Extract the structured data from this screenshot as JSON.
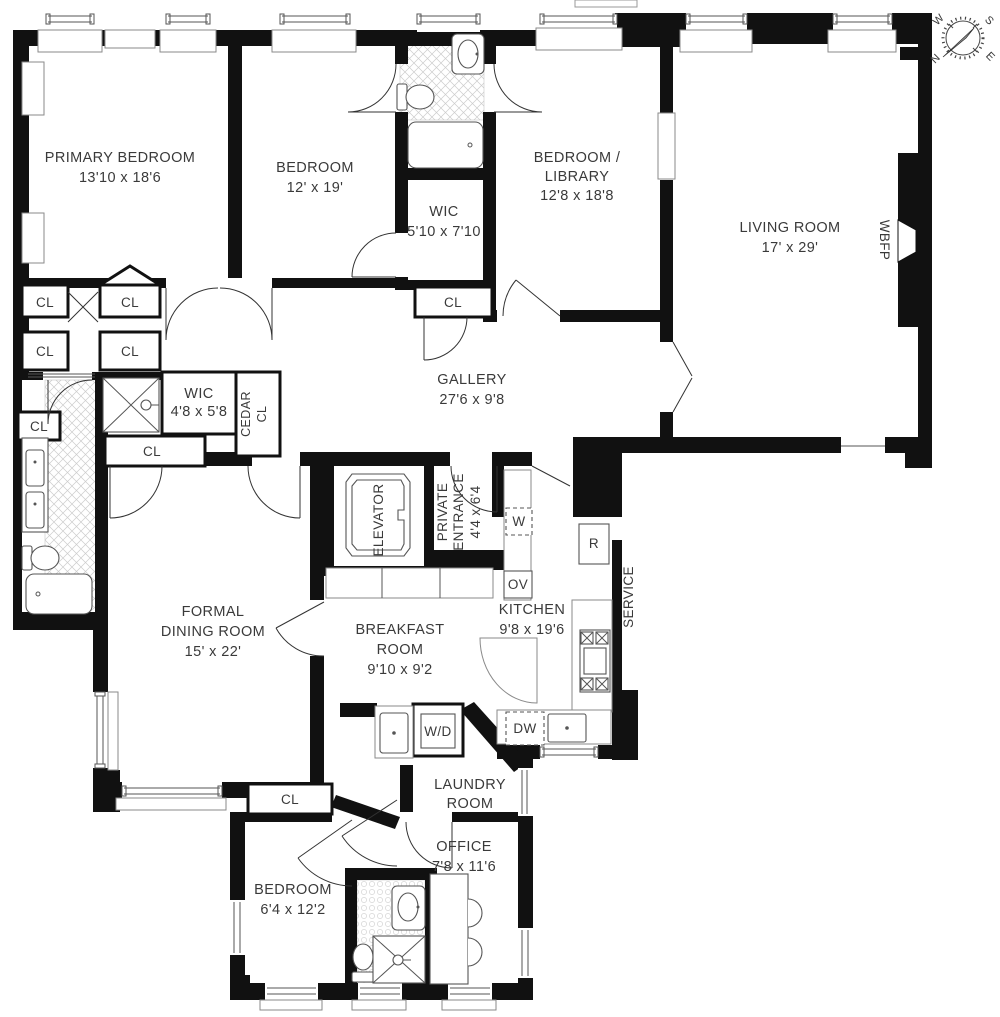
{
  "plan_title": "Four Bedroom Apartment Floor Plan",
  "colors": {
    "wall": "#111111",
    "text": "#3a3a3a",
    "tile_line": "#cccccc",
    "fixture_line": "#555555"
  },
  "rooms": {
    "primary_bedroom": {
      "name": "PRIMARY BEDROOM",
      "dims": "13'10 x 18'6"
    },
    "bedroom2": {
      "name": "BEDROOM",
      "dims": "12' x 19'"
    },
    "wic_top": {
      "name": "WIC",
      "dims": "5'10 x 7'10"
    },
    "library": {
      "name": "BEDROOM /",
      "name2": "LIBRARY",
      "dims": "12'8 x 18'8"
    },
    "living_room": {
      "name": "LIVING ROOM",
      "dims": "17' x 29'"
    },
    "gallery": {
      "name": "GALLERY",
      "dims": "27'6 x 9'8"
    },
    "wic_mid": {
      "name": "WIC",
      "dims": "4'8 x 5'8"
    },
    "cedar_closet": {
      "name": "CEDAR",
      "name2": "CL"
    },
    "elevator": {
      "name": "ELEVATOR"
    },
    "private_entrance": {
      "name": "PRIVATE",
      "name2": "ENTRANCE",
      "dims": "4'4 x 6'4"
    },
    "service": {
      "name": "SERVICE"
    },
    "kitchen": {
      "name": "KITCHEN",
      "dims": "9'8 x 19'6"
    },
    "dining": {
      "name": "FORMAL",
      "name2": "DINING ROOM",
      "dims": "15' x 22'"
    },
    "breakfast": {
      "name": "BREAKFAST",
      "name2": "ROOM",
      "dims": "9'10 x 9'2"
    },
    "laundry": {
      "name": "LAUNDRY",
      "name2": "ROOM"
    },
    "office": {
      "name": "OFFICE",
      "dims": "7'8 x 11'6"
    },
    "bedroom3": {
      "name": "BEDROOM",
      "dims": "6'4 x 12'2"
    }
  },
  "fixtures": {
    "closet": "CL",
    "washer": "W",
    "refrigerator": "R",
    "oven": "OV",
    "dishwasher": "DW",
    "washer_dryer": "W/D",
    "fireplace": "WBFP"
  },
  "compass": {
    "n": "N",
    "s": "S",
    "e": "E",
    "w": "W"
  }
}
